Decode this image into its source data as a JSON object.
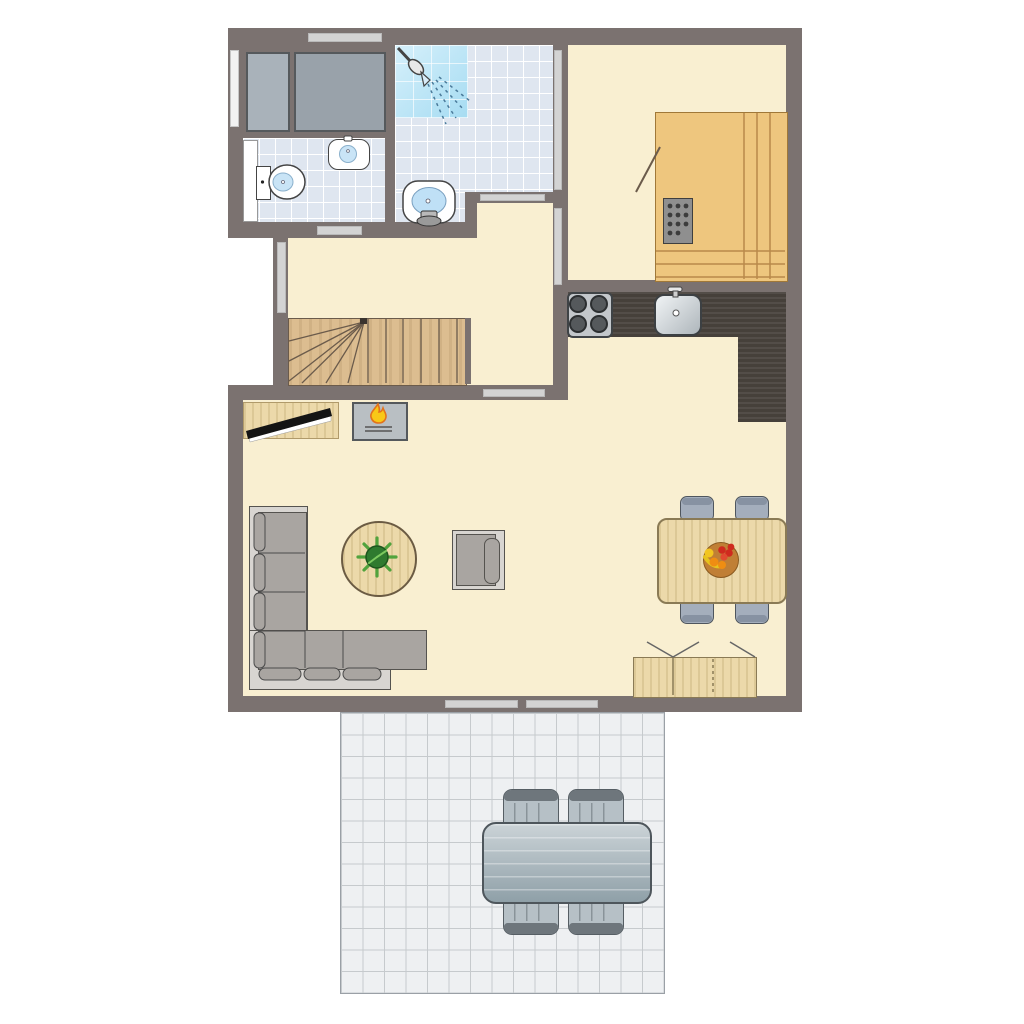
{
  "type": "architectural-floor-plan",
  "colors": {
    "wall": "#7b7270",
    "floor": "#f9efd1",
    "tile": "#dfe6f0",
    "tile-line": "#ffffff",
    "shower-a": "#d6f0fb",
    "shower-b": "#a6dcf2",
    "sauna-wood": "#eec67e",
    "sauna-line": "#b9894a",
    "stair-wood": "#dcbd90",
    "counter": "#46403a",
    "wood": "#ecd9aa",
    "wood-border": "#8a7a55",
    "sofa-frame": "#d8d5d1",
    "sofa-seat": "#a9a5a1",
    "dark-line": "#55534f",
    "box1": "#a9b2ba",
    "box2": "#99a2aa",
    "chair": "#a4aebc",
    "chair-back": "#8792a2",
    "terrace-tile": "#eef0f2",
    "terrace-line": "#c6cacd",
    "out-table-a": "#cbd3d7",
    "out-table-b": "#8fa0a8",
    "out-chair": "#b6c0c6",
    "out-chair-back": "#6e767c",
    "opening": "#d3d3d3",
    "appliance": "#c3c7cb",
    "flame-y": "#f8c818",
    "flame-o": "#e2731c",
    "plant-a": "#2f7a2f",
    "plant-b": "#51a33d"
  },
  "rooms": [
    {
      "name": "bathroom",
      "features": [
        "shower",
        "pedestal-sink",
        "tiled-floor"
      ]
    },
    {
      "name": "toilet-room",
      "features": [
        "toilet",
        "washbasin",
        "tiled-floor",
        "door"
      ]
    },
    {
      "name": "storage-closet",
      "features": [
        "wardrobe-unit",
        "wardrobe-unit"
      ]
    },
    {
      "name": "sauna-room",
      "features": [
        "sauna-bench",
        "sauna-heater",
        "glass-door"
      ]
    },
    {
      "name": "hallway",
      "features": [
        "staircase",
        "window"
      ]
    },
    {
      "name": "kitchen",
      "features": [
        "l-shaped-counter",
        "stove",
        "sink"
      ]
    },
    {
      "name": "living-room",
      "features": [
        "corner-sofa",
        "coffee-table",
        "plant",
        "armchair",
        "tv-console",
        "tv",
        "fireplace"
      ]
    },
    {
      "name": "dining-area",
      "features": [
        "dining-table",
        "fruit-bowl",
        "four-chairs",
        "sideboard"
      ]
    },
    {
      "name": "terrace",
      "features": [
        "tiled-patio",
        "outdoor-table",
        "four-outdoor-chairs"
      ]
    }
  ],
  "openings": [
    {
      "name": "window-top-wall"
    },
    {
      "name": "window-left-wall"
    },
    {
      "name": "door-toilet-hall"
    },
    {
      "name": "window-hall-left"
    },
    {
      "name": "glazing-bathroom-sauna"
    },
    {
      "name": "door-hall-sauna"
    },
    {
      "name": "door-hall-bathroom"
    },
    {
      "name": "door-hall-living"
    },
    {
      "name": "sliding-door-terrace-left"
    },
    {
      "name": "sliding-door-terrace-right"
    }
  ],
  "furniture_counts": {
    "indoor_dining_chairs": 4,
    "outdoor_chairs": 4,
    "sofa_sections": 2,
    "wardrobe_units": 2
  }
}
